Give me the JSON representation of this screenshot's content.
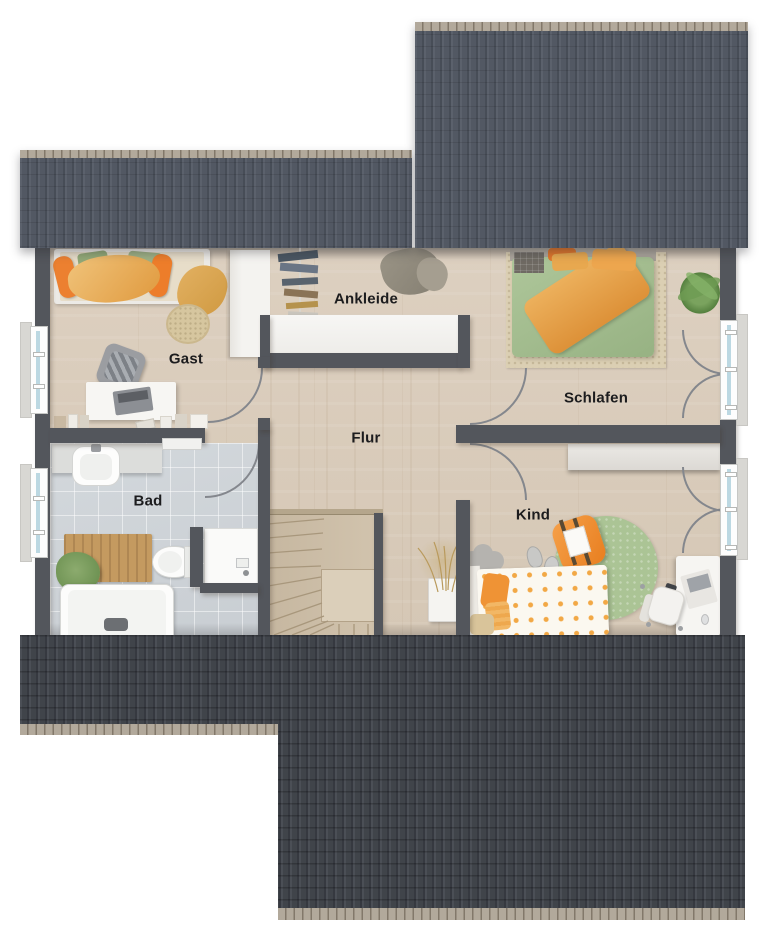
{
  "rooms": [
    {
      "id": "gast",
      "label": "Gast"
    },
    {
      "id": "ankleide",
      "label": "Ankleide"
    },
    {
      "id": "schlafen",
      "label": "Schlafen"
    },
    {
      "id": "flur",
      "label": "Flur"
    },
    {
      "id": "bad",
      "label": "Bad"
    },
    {
      "id": "kind",
      "label": "Kind"
    }
  ],
  "palette": {
    "wall": "#53565c",
    "roof_top": "#525863",
    "roof_bottom": "#3f434a",
    "ridge_cap": "#b2a99b",
    "floor_wood": "#d9ccbb",
    "floor_tile": "#cfd4d8",
    "furniture_white": "#f5f4f1",
    "accent_orange": "#ec8030",
    "accent_orange_light": "#edb064",
    "duvet_green": "#a3bd8e",
    "rug_green": "#abc495",
    "rug_beige": "#dbcfb3",
    "stair_wood": "#cec0aa",
    "window_glass": "#bcd8e2",
    "door_arc": "#84878d",
    "label_text": "#1c1c1e"
  }
}
